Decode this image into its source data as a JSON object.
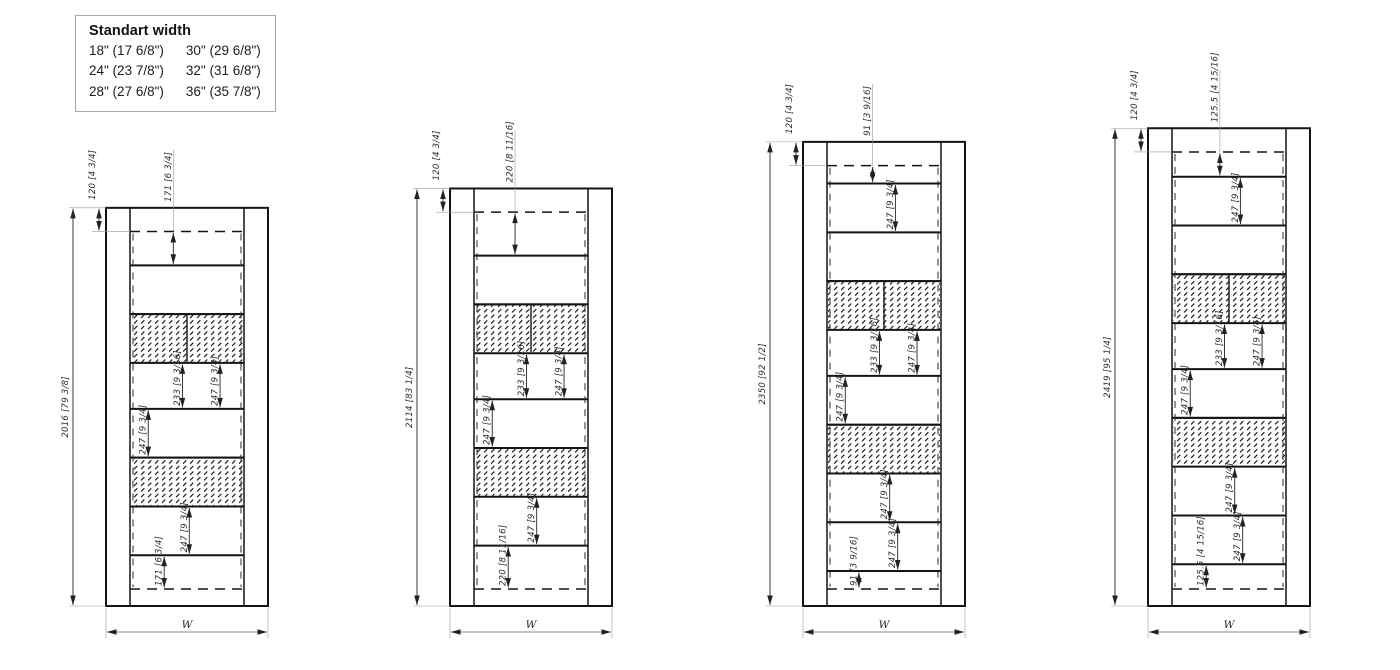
{
  "legend": {
    "title": "Standart width",
    "columns": [
      [
        "18\" (17 6/8\")",
        "24\" (23 7/8\")",
        "28\" (27 6/8\")"
      ],
      [
        "30\" (29 6/8\")",
        "32\" (31 6/8\")",
        "36\" (35 7/8\")"
      ]
    ]
  },
  "drawing": {
    "description": "Four cabinet elevation views with metric [imperial] dimensions",
    "cabinets": [
      {
        "name": "cabinet-1",
        "total_mm": 2016,
        "total_label": "2016 [79 3/8]",
        "top_mm": 120,
        "top_label": "120 [4 3/4]",
        "width_label": "W",
        "rows": [
          {
            "mm": 171,
            "type": "open",
            "labels": [
              {
                "text": "171 [6 3/4]",
                "x": 0.38,
                "up": true
              }
            ]
          },
          {
            "mm": 247,
            "type": "open"
          },
          {
            "mm": 247,
            "type": "hatch",
            "divider": true
          },
          {
            "mm": 233,
            "type": "open",
            "labels": [
              {
                "text": "233 [9 3/16]",
                "x": 0.46
              },
              {
                "text": "247 [9 3/4]",
                "x": 0.79
              }
            ]
          },
          {
            "mm": 247,
            "type": "open",
            "labels": [
              {
                "text": "247 [9 3/4]",
                "x": 0.16
              }
            ]
          },
          {
            "mm": 247,
            "type": "hatch"
          },
          {
            "mm": 247,
            "type": "open",
            "labels": [
              {
                "text": "247 [9 3/4]",
                "x": 0.52
              }
            ]
          },
          {
            "mm": 171,
            "type": "open",
            "labels": [
              {
                "text": "171 [6 3/4]",
                "x": 0.3
              }
            ]
          }
        ]
      },
      {
        "name": "cabinet-2",
        "total_mm": 2114,
        "total_label": "2114 [83 1/4]",
        "top_mm": 120,
        "top_label": "120 [4 3/4]",
        "width_label": "W",
        "rows": [
          {
            "mm": 220,
            "type": "open",
            "labels": [
              {
                "text": "220 [8 11/16]",
                "x": 0.36,
                "up": true
              }
            ]
          },
          {
            "mm": 247,
            "type": "open"
          },
          {
            "mm": 247,
            "type": "hatch",
            "divider": true
          },
          {
            "mm": 233,
            "type": "open",
            "labels": [
              {
                "text": "233 [9 3/16]",
                "x": 0.46
              },
              {
                "text": "247 [9 3/4]",
                "x": 0.79
              }
            ]
          },
          {
            "mm": 247,
            "type": "open",
            "labels": [
              {
                "text": "247 [9 3/4]",
                "x": 0.16
              }
            ]
          },
          {
            "mm": 247,
            "type": "hatch"
          },
          {
            "mm": 247,
            "type": "open",
            "labels": [
              {
                "text": "247 [9 3/4]",
                "x": 0.55
              }
            ]
          },
          {
            "mm": 220,
            "type": "open",
            "labels": [
              {
                "text": "220 [8 11/16]",
                "x": 0.3
              }
            ]
          }
        ]
      },
      {
        "name": "cabinet-3",
        "total_mm": 2350,
        "total_label": "2350 [92 1/2]",
        "top_mm": 120,
        "top_label": "120 [4 3/4]",
        "width_label": "W",
        "rows": [
          {
            "mm": 91,
            "type": "open",
            "labels": [
              {
                "text": "91 [3 9/16]",
                "x": 0.4,
                "up": true
              }
            ]
          },
          {
            "mm": 247,
            "type": "open",
            "labels": [
              {
                "text": "247 [9 3/4]",
                "x": 0.6
              }
            ]
          },
          {
            "mm": 247,
            "type": "open"
          },
          {
            "mm": 247,
            "type": "hatch",
            "divider": true
          },
          {
            "mm": 233,
            "type": "open",
            "labels": [
              {
                "text": "233 [9 3/16]",
                "x": 0.46
              },
              {
                "text": "247 [9 3/4]",
                "x": 0.79
              }
            ]
          },
          {
            "mm": 247,
            "type": "open",
            "labels": [
              {
                "text": "247 [9 3/4]",
                "x": 0.16
              }
            ]
          },
          {
            "mm": 247,
            "type": "hatch"
          },
          {
            "mm": 247,
            "type": "open",
            "labels": [
              {
                "text": "247 [9 3/4]",
                "x": 0.55
              }
            ]
          },
          {
            "mm": 247,
            "type": "open",
            "labels": [
              {
                "text": "247 [9 3/4]",
                "x": 0.62
              }
            ]
          },
          {
            "mm": 91,
            "type": "open",
            "labels": [
              {
                "text": "91 [3 9/16]",
                "x": 0.28
              }
            ]
          }
        ]
      },
      {
        "name": "cabinet-4",
        "total_mm": 2419,
        "total_label": "2419 [95 1/4]",
        "top_mm": 120,
        "top_label": "120 [4 3/4]",
        "width_label": "W",
        "rows": [
          {
            "mm": 125.5,
            "type": "open",
            "labels": [
              {
                "text": "125.5 [4 15/16]",
                "x": 0.42,
                "up": true
              }
            ]
          },
          {
            "mm": 247,
            "type": "open",
            "labels": [
              {
                "text": "247 [9 3/4]",
                "x": 0.6
              }
            ]
          },
          {
            "mm": 247,
            "type": "open"
          },
          {
            "mm": 247,
            "type": "hatch",
            "divider": true
          },
          {
            "mm": 233,
            "type": "open",
            "labels": [
              {
                "text": "233 [9 3/16]",
                "x": 0.46
              },
              {
                "text": "247 [9 3/4]",
                "x": 0.79
              }
            ]
          },
          {
            "mm": 247,
            "type": "open",
            "labels": [
              {
                "text": "247 [9 3/4]",
                "x": 0.16
              }
            ]
          },
          {
            "mm": 247,
            "type": "hatch"
          },
          {
            "mm": 247,
            "type": "open",
            "labels": [
              {
                "text": "247 [9 3/4]",
                "x": 0.55
              }
            ]
          },
          {
            "mm": 247,
            "type": "open",
            "labels": [
              {
                "text": "247 [9 3/4]",
                "x": 0.62
              }
            ]
          },
          {
            "mm": 125.5,
            "type": "open",
            "labels": [
              {
                "text": "125.5 [4 15/16]",
                "x": 0.3
              }
            ]
          }
        ]
      }
    ]
  }
}
